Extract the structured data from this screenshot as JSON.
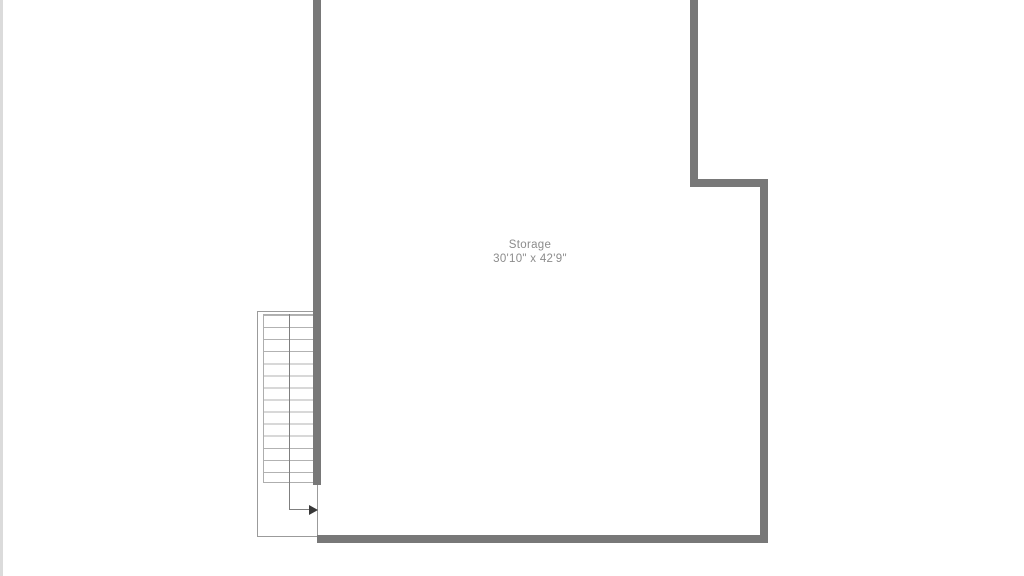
{
  "room": {
    "name": "Storage",
    "dimensions": "30'10\" x 42'9\""
  },
  "stairs": {
    "tread_count": 14,
    "direction": "exit-right"
  },
  "colors": {
    "background": "#ffffff",
    "wall": "#787878",
    "stairwell_outline": "#9b9b9b",
    "tread_line": "#b2b2b2",
    "walk_line": "#7f7f7f",
    "arrow": "#383838",
    "label_text": "#8c8c8c",
    "edge_strip": "#dbdbdb"
  }
}
